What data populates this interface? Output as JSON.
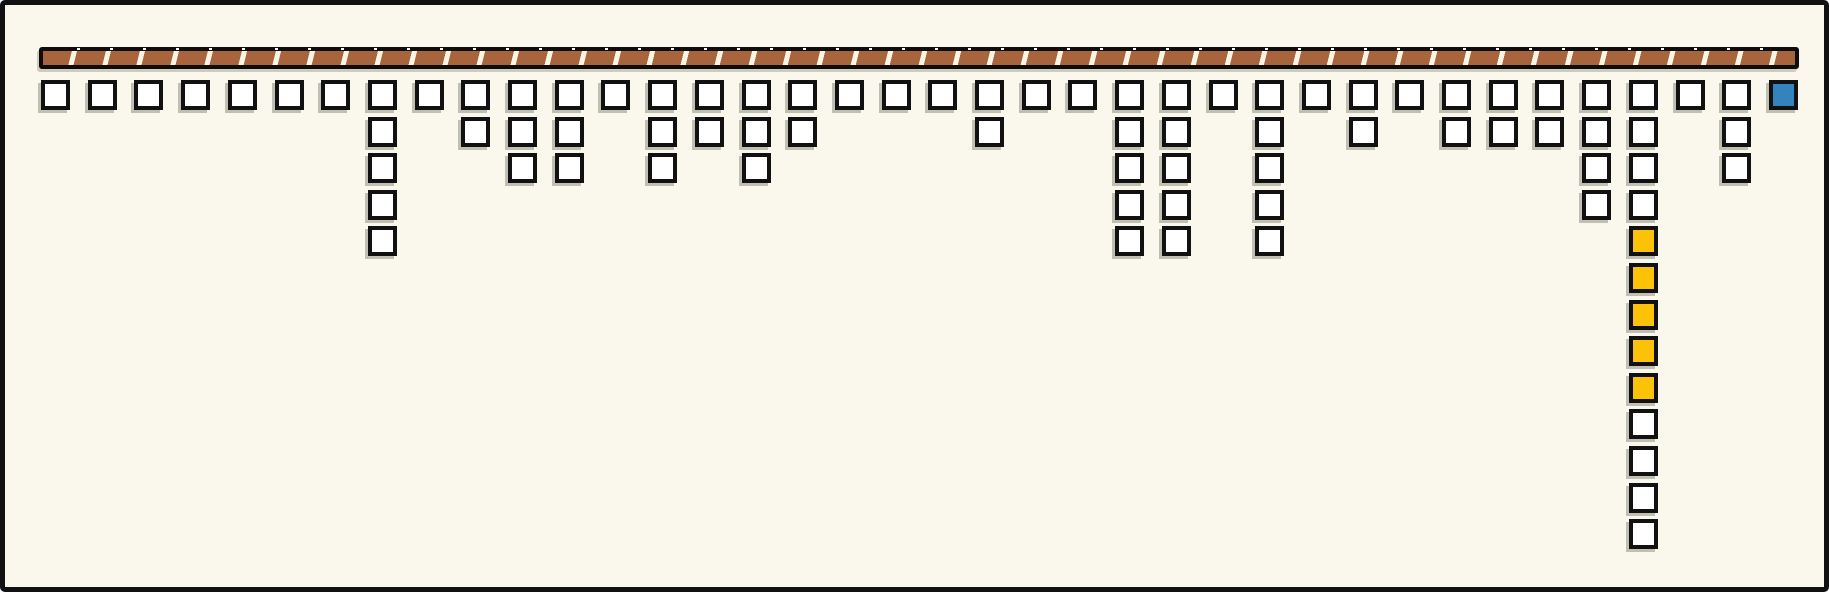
{
  "board": {
    "background_color": "#FAF8EC",
    "frame_color": "#111111",
    "beam": {
      "label": "hatched-beam",
      "segment_fill": "#A8643C",
      "gap_color": "#F8F4E6",
      "edge_color": "#0D0D0D"
    },
    "palette": {
      "white": "#FFFFFF",
      "yellow": "#FCC208",
      "blue": "#3583BC"
    },
    "cell_border_color": "#111111",
    "counts_note": "38 columns of square tiles hang below the hatched beam; cells listed top to bottom",
    "columns": [
      {
        "cells": [
          "white"
        ]
      },
      {
        "cells": [
          "white"
        ]
      },
      {
        "cells": [
          "white"
        ]
      },
      {
        "cells": [
          "white"
        ]
      },
      {
        "cells": [
          "white"
        ]
      },
      {
        "cells": [
          "white"
        ]
      },
      {
        "cells": [
          "white"
        ]
      },
      {
        "cells": [
          "white",
          "white",
          "white",
          "white",
          "white"
        ]
      },
      {
        "cells": [
          "white"
        ]
      },
      {
        "cells": [
          "white",
          "white"
        ]
      },
      {
        "cells": [
          "white",
          "white",
          "white"
        ]
      },
      {
        "cells": [
          "white",
          "white",
          "white"
        ]
      },
      {
        "cells": [
          "white"
        ]
      },
      {
        "cells": [
          "white",
          "white",
          "white"
        ]
      },
      {
        "cells": [
          "white",
          "white"
        ]
      },
      {
        "cells": [
          "white",
          "white",
          "white"
        ]
      },
      {
        "cells": [
          "white",
          "white"
        ]
      },
      {
        "cells": [
          "white"
        ]
      },
      {
        "cells": [
          "white"
        ]
      },
      {
        "cells": [
          "white"
        ]
      },
      {
        "cells": [
          "white",
          "white"
        ]
      },
      {
        "cells": [
          "white"
        ]
      },
      {
        "cells": [
          "white"
        ]
      },
      {
        "cells": [
          "white",
          "white",
          "white",
          "white",
          "white"
        ]
      },
      {
        "cells": [
          "white",
          "white",
          "white",
          "white",
          "white"
        ]
      },
      {
        "cells": [
          "white"
        ]
      },
      {
        "cells": [
          "white",
          "white",
          "white",
          "white",
          "white"
        ]
      },
      {
        "cells": [
          "white"
        ]
      },
      {
        "cells": [
          "white",
          "white"
        ]
      },
      {
        "cells": [
          "white"
        ]
      },
      {
        "cells": [
          "white",
          "white"
        ]
      },
      {
        "cells": [
          "white",
          "white"
        ]
      },
      {
        "cells": [
          "white",
          "white"
        ]
      },
      {
        "cells": [
          "white",
          "white",
          "white",
          "white"
        ]
      },
      {
        "cells": [
          "white",
          "white",
          "white",
          "white",
          "yellow",
          "yellow",
          "yellow",
          "yellow",
          "yellow",
          "white",
          "white",
          "white",
          "white"
        ]
      },
      {
        "cells": [
          "white"
        ]
      },
      {
        "cells": [
          "white",
          "white",
          "white"
        ]
      },
      {
        "cells": [
          "blue"
        ]
      }
    ]
  }
}
